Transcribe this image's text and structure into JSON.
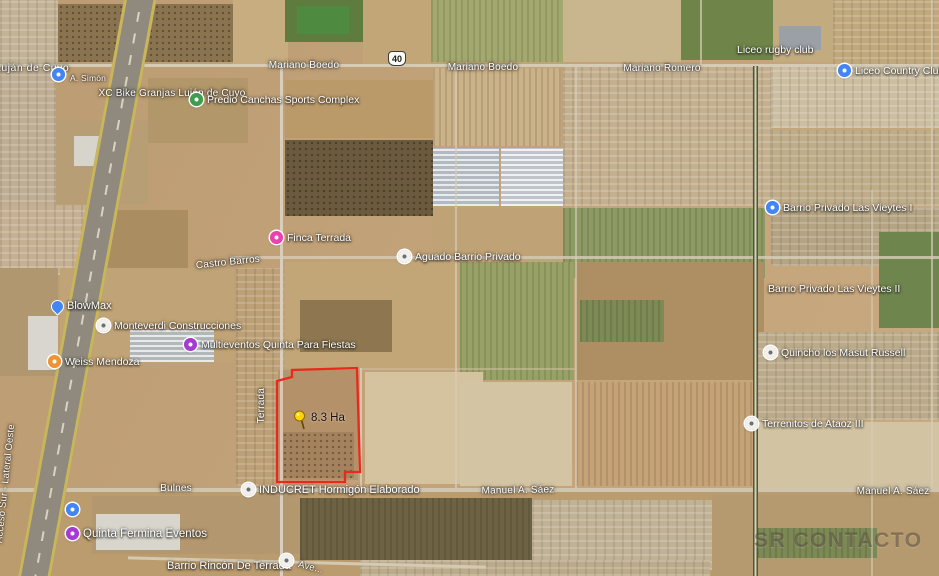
{
  "map": {
    "view": "satellite",
    "highway_shield": "40",
    "area_measurement": "8.3 Ha",
    "watermark": "SR CONTACTO"
  },
  "street_labels": {
    "lujan_de_cuyo": "Luján de Cuyo",
    "a_simon": "A. Simón",
    "mariano_boedo_1": "Mariano Boedo",
    "mariano_boedo_2": "Mariano Boedo",
    "mariano_romero": "Mariano Romero",
    "xc_bike": "XC Bike Granjas Luján de Cuyo",
    "castro_barros": "Castro Barros",
    "terrada": "Terrada",
    "bulnes": "Bulnes",
    "manuel_a_saez_1": "Manuel A. Sáez",
    "manuel_a_saez_2": "Manuel A. Sáez",
    "acceso_sur_lateral": "Acceso Sur - Lateral Oeste",
    "avenida_partial": "Ave..."
  },
  "poi_labels": {
    "liceo_rugby_club": "Liceo rugby club",
    "liceo_country_club": "Liceo Country Club",
    "predio_sports": "Predio Canchas Sports Complex",
    "finca_terrada": "Finca Terrada",
    "aguado_barrio_privado": "Aguado Barrio Privado",
    "blowmax": "BlowMax",
    "monteverdi": "Monteverdi Construcciones",
    "multieventos": "Multieventos Quinta Para Fiestas",
    "weiss_mendoza": "Weiss Mendoza",
    "las_vieytes_1": "Barrio Privado Las Vieytes I",
    "las_vieytes_2": "Barrio Privado Las Vieytes II",
    "quincho_russell": "Quincho los Masut Russell",
    "terrenitos": "Terrenitos de Ataoz III",
    "inducret": "INDUCRET Hormigón Elaborado",
    "quinta_fermina": "Quinta Fermina Eventos",
    "barrio_rincon": "Barrio Rincón De Terrada"
  },
  "colors": {
    "parcel_outline": "#e8291c",
    "pushpin_yellow": "#ffd400",
    "poi_blue": "#4285f4",
    "poi_purple": "#a63bd4",
    "poi_pink": "#ef3fae",
    "poi_orange": "#f09334",
    "poi_green": "#3f9d4e",
    "poi_grey": "#f2f0ec",
    "highway_line_yellow": "#c9b55a"
  }
}
